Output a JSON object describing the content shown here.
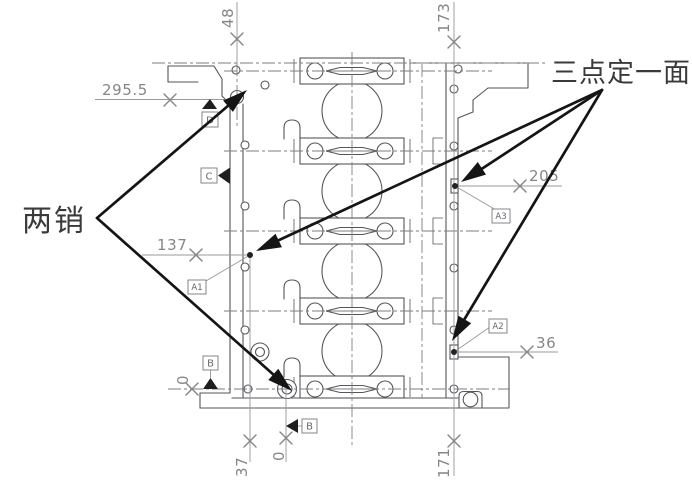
{
  "drawing": {
    "kind": "engine-block-fixture-datum-drawing",
    "annotations": {
      "two_pins": "两销",
      "three_points_plane": "三点定一面"
    },
    "dimensions": {
      "top_left_vertical": "48",
      "top_right_vertical": "173",
      "upper_left_horizontal": "295.5",
      "mid_left_horizontal": "137",
      "right_upper_horizontal": "205",
      "right_lower_horizontal": "36",
      "left_zero": "0",
      "bottom_left_vertical": "37",
      "bottom_zero": "0",
      "bottom_right_vertical": "171"
    },
    "datum_features": {
      "d": "D",
      "c": "C",
      "b_side": "B",
      "b_bottom": "B"
    },
    "datum_targets": {
      "a1": "A1",
      "a2": "A2",
      "a3": "A3"
    },
    "colors": {
      "outline": "#55565a",
      "centerline": "#7d7e82",
      "dimension": "#97989c",
      "dimension_text": "#85868a",
      "arrow": "#151515",
      "annotation_text": "#3a3a3c",
      "background": "#ffffff"
    }
  }
}
